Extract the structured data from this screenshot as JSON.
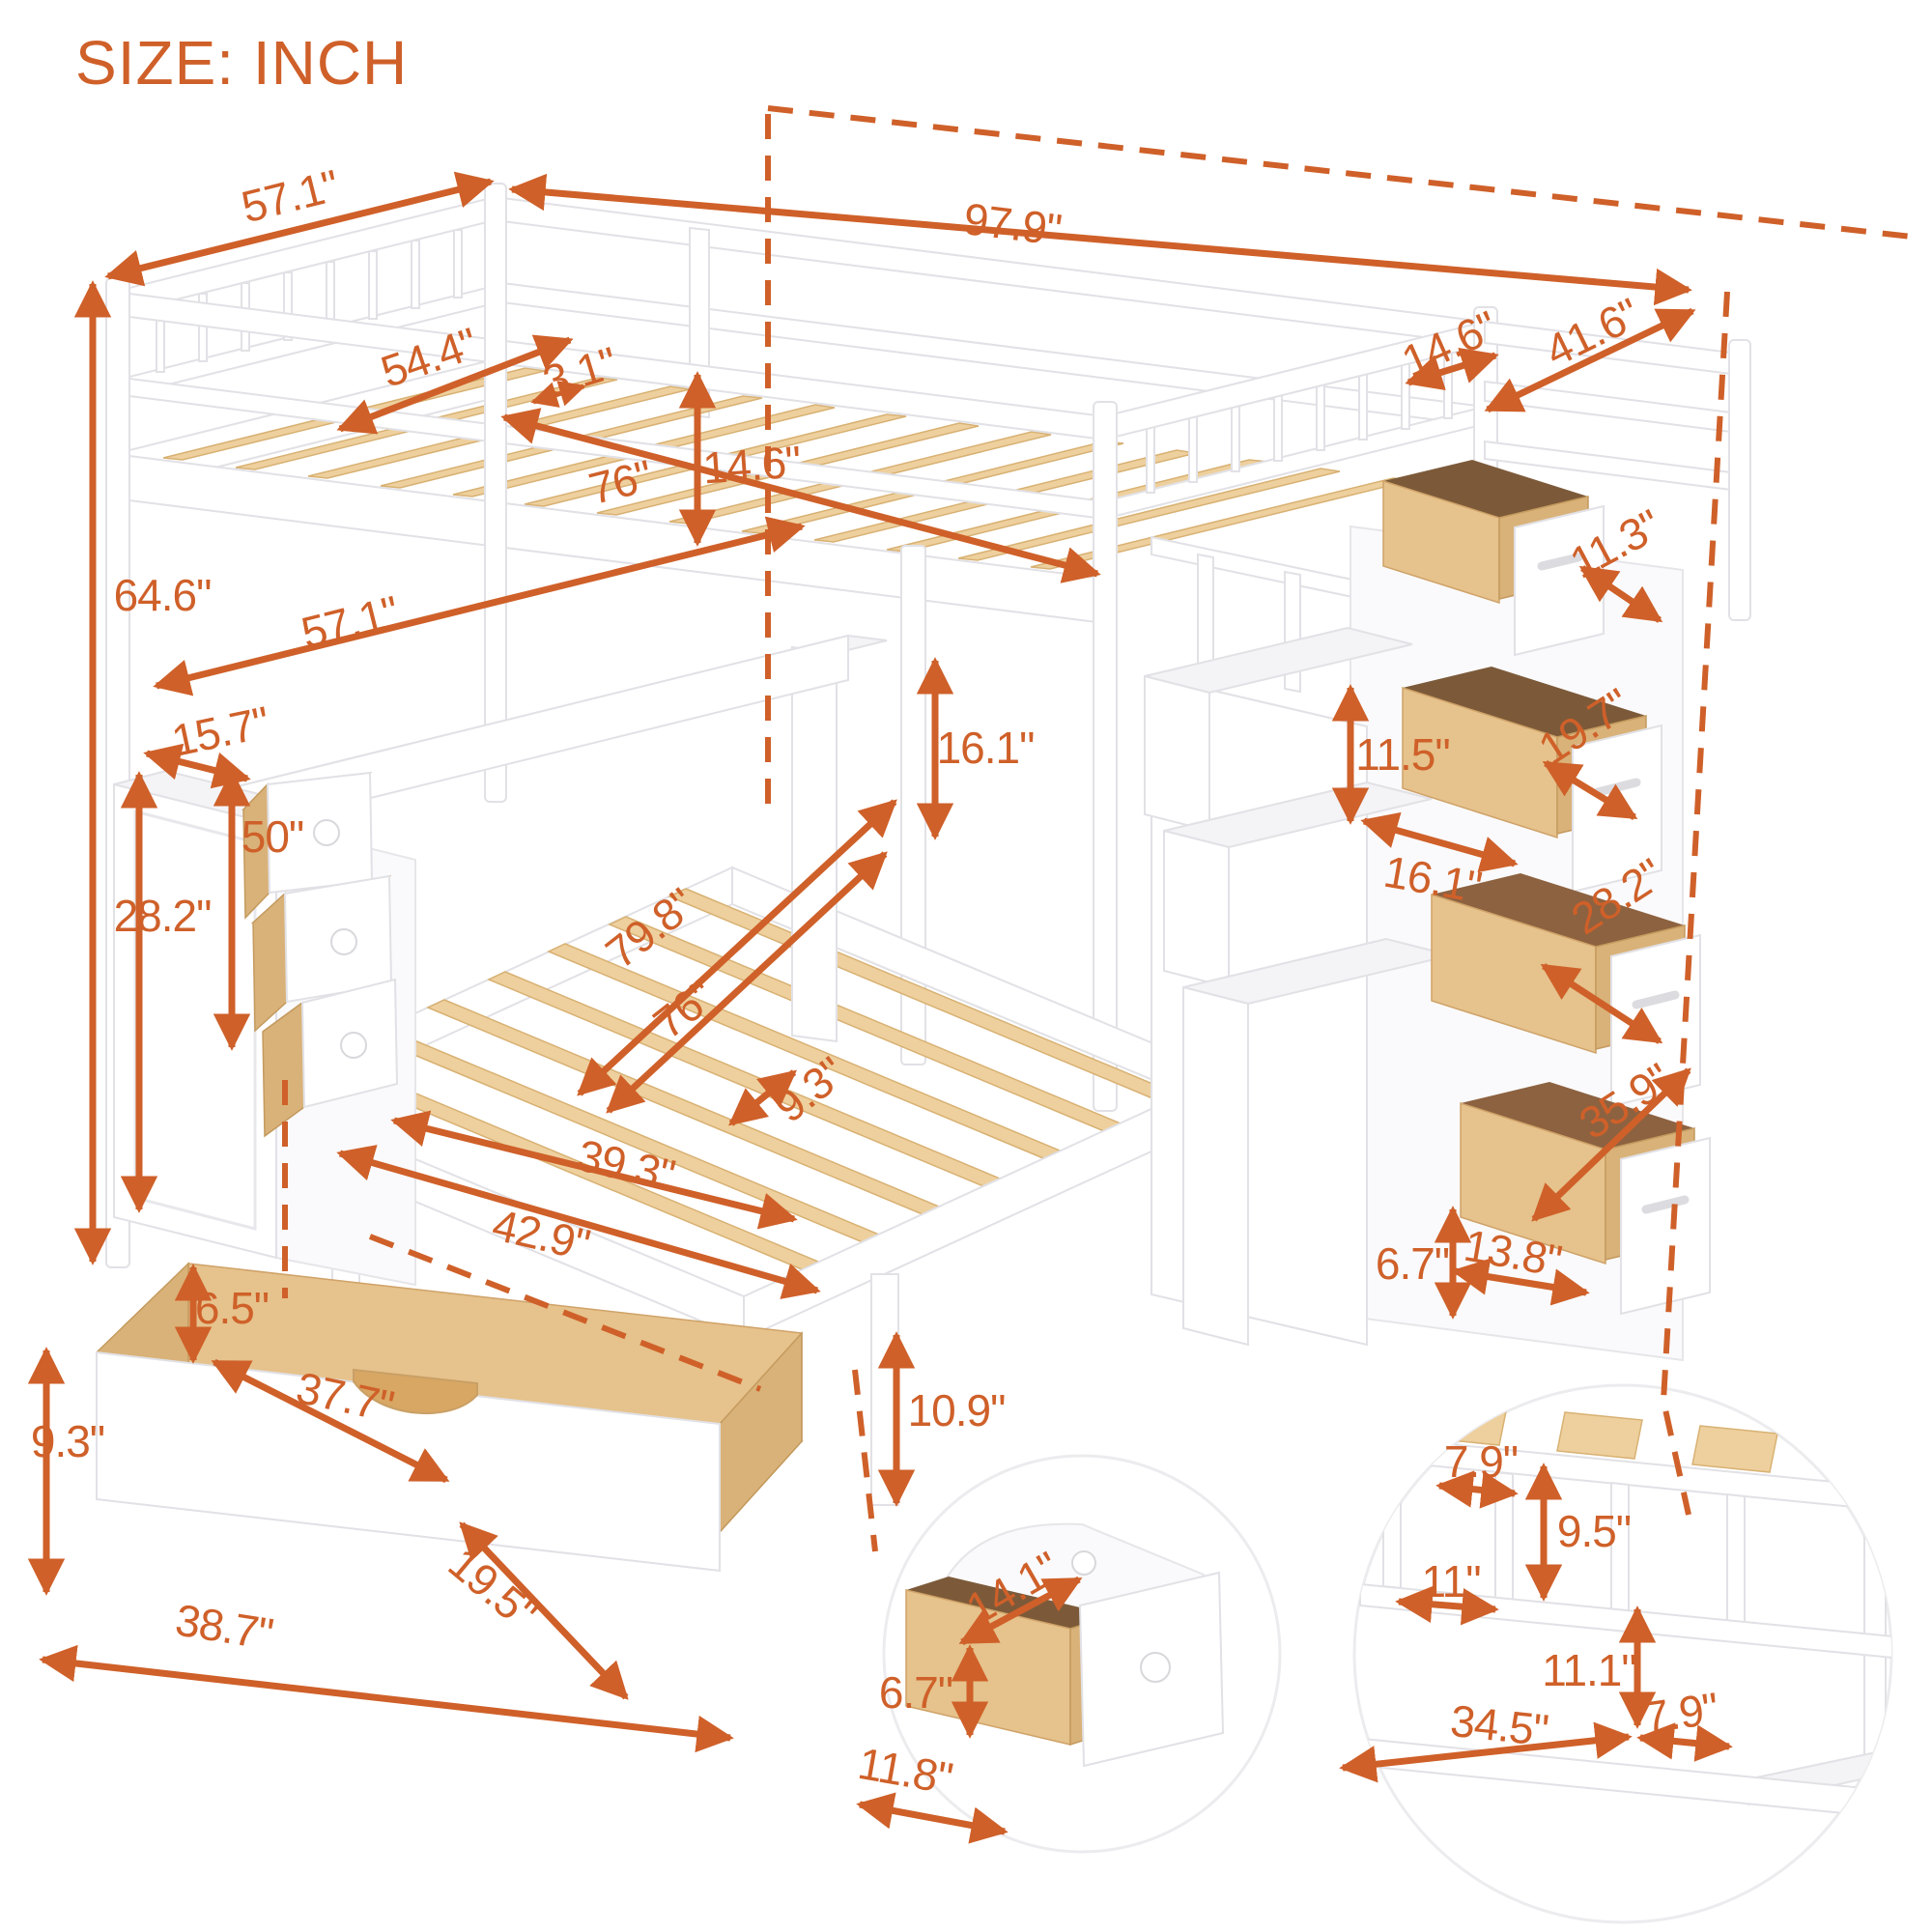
{
  "title": "SIZE: INCH",
  "accent_color": "#cf6029",
  "dims": {
    "upper_width_outer": "57.1\"",
    "total_length": "97.9\"",
    "head_overhang": "14.6\"",
    "stair_length": "41.6\"",
    "upper_slat_width": "54.4\"",
    "rail_thickness": "3.1\"",
    "upper_bed_length": "76\"",
    "upper_guard_height": "14.6\"",
    "total_height": "64.6\"",
    "desk_length": "57.1\"",
    "cabinet_depth": "15.7\"",
    "under_bed_clearance": "50\"",
    "cabinet_height": "28.2\"",
    "lower_bed_length": "79.8\"",
    "lower_slat_length": "76\"",
    "lower_guard_height": "16.1\"",
    "slat_spacing": "9.3\"",
    "lower_slat_width": "39.3\"",
    "lower_bed_width": "42.9\"",
    "stair_drawer_1_depth": "11.3\"",
    "stair_drawer_2_depth": "19.7\"",
    "step_riser_height": "11.5\"",
    "step_tread_depth": "16.1\"",
    "stair_drawer_3_depth": "28.2\"",
    "stair_drawer_4_depth": "35.9\"",
    "stair_drawer_front_height": "6.7\"",
    "stair_drawer_width": "13.8\"",
    "storage_drawer_inner_height": "6.5\"",
    "storage_drawer_inner_length": "37.7\"",
    "storage_drawer_height": "9.3\"",
    "storage_drawer_length": "38.7\"",
    "storage_drawer_depth": "19.5\"",
    "leg_height": "10.9\"",
    "step_drawer_depth": "14.1\"",
    "step_drawer_height": "6.7\"",
    "step_drawer_width": "11.8\"",
    "cubby_divider_gap": "7.9\"",
    "cubby_height": "9.5\"",
    "cubby_width": "11\"",
    "hutch_clearance": "11.1\"",
    "desk_surface_length": "34.5\"",
    "desk_surface_depth": "7.9\""
  }
}
